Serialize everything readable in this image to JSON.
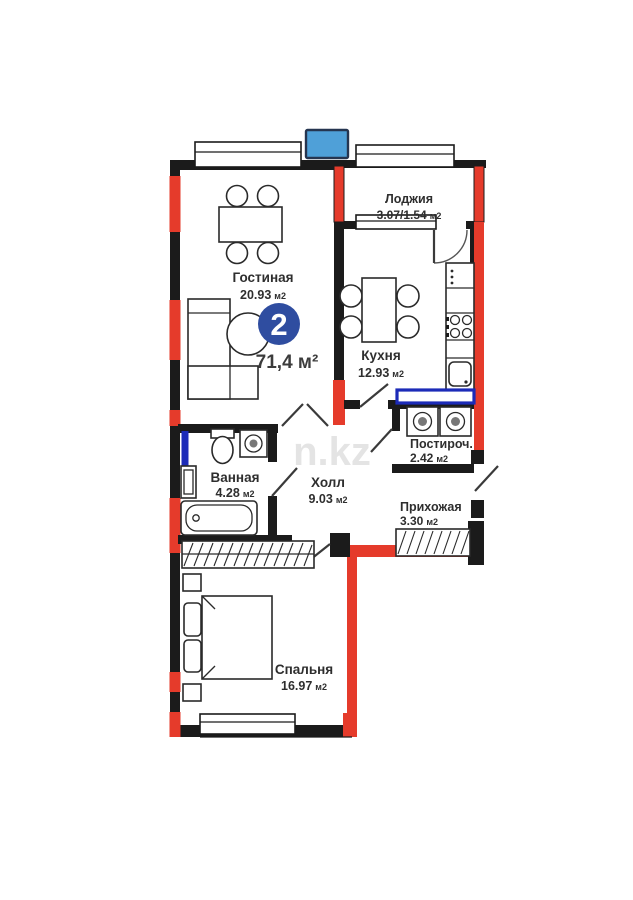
{
  "floorplan": {
    "badge_rooms": "2",
    "total_area": "71,4 м²",
    "watermark": "n.kz",
    "rooms": [
      {
        "id": "living",
        "name": "Гостиная",
        "area": "20.93",
        "unit": "м2"
      },
      {
        "id": "loggia",
        "name": "Лоджия",
        "area": "3.07/1.54",
        "unit": "м2"
      },
      {
        "id": "kitchen",
        "name": "Кухня",
        "area": "12.93",
        "unit": "м2"
      },
      {
        "id": "laundry",
        "name": "Постироч.",
        "area": "2.42",
        "unit": "м2"
      },
      {
        "id": "hall",
        "name": "Холл",
        "area": "9.03",
        "unit": "м2"
      },
      {
        "id": "bathroom",
        "name": "Ванная",
        "area": "4.28",
        "unit": "м2"
      },
      {
        "id": "entry",
        "name": "Прихожая",
        "area": "3.30",
        "unit": "м2"
      },
      {
        "id": "bedroom",
        "name": "Спальня",
        "area": "16.97",
        "unit": "м2"
      }
    ],
    "colors": {
      "wall": "#1b1b1b",
      "bearing_red": "#e53b2b",
      "partition_blue": "#1c2bb8",
      "marker_blue": "#4fa0d8",
      "badge_blue": "#2f4da0",
      "text": "#2e2e2e",
      "watermark_gray": "#bdbdbd"
    }
  }
}
